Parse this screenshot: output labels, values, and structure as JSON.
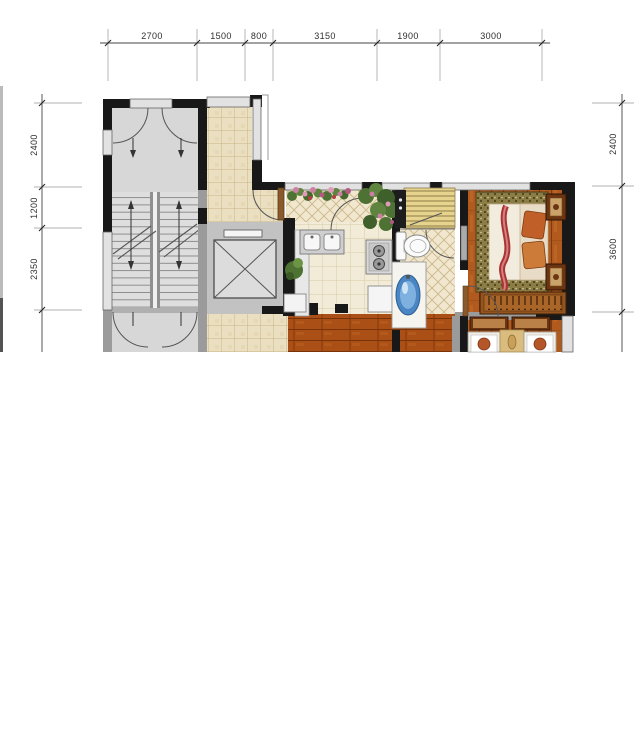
{
  "document": {
    "kind": "residential floor plan (cropped)"
  },
  "dims": {
    "top": [
      "2700",
      "1500",
      "800",
      "3150",
      "1900",
      "3000"
    ],
    "left": [
      "2400",
      "1200",
      "2350"
    ],
    "right": [
      "2400",
      "3600"
    ]
  },
  "fixtures": {
    "icons": [
      "stairs-icon",
      "elevator-icon",
      "door-swing-icon",
      "kitchen-sink-icon",
      "gas-stove-icon",
      "refrigerator-icon",
      "water-heater-icon",
      "toilet-icon",
      "washbasin-icon",
      "double-bed-icon",
      "nightstand-icon",
      "wardrobe-hangers-icon",
      "flower-box-icon",
      "plant-icon"
    ]
  },
  "colors": {
    "wall_black": "#181818",
    "wall_gray": "#9b9b9b",
    "window_fill": "#e2e2e2",
    "stair_floor": "#d7d7d7",
    "tile_corridor": "#eadfc0",
    "tile_kitchen": "#f2ebd8",
    "wood_bedroom": "#b05a1e",
    "wood_living": "#aa4f16",
    "bed_border": "#8c7d46",
    "basin_blue": "#4a86c4",
    "plant_green": "#4e7233",
    "flower_pink": "#cc7fa2",
    "dim_line": "#444444"
  }
}
